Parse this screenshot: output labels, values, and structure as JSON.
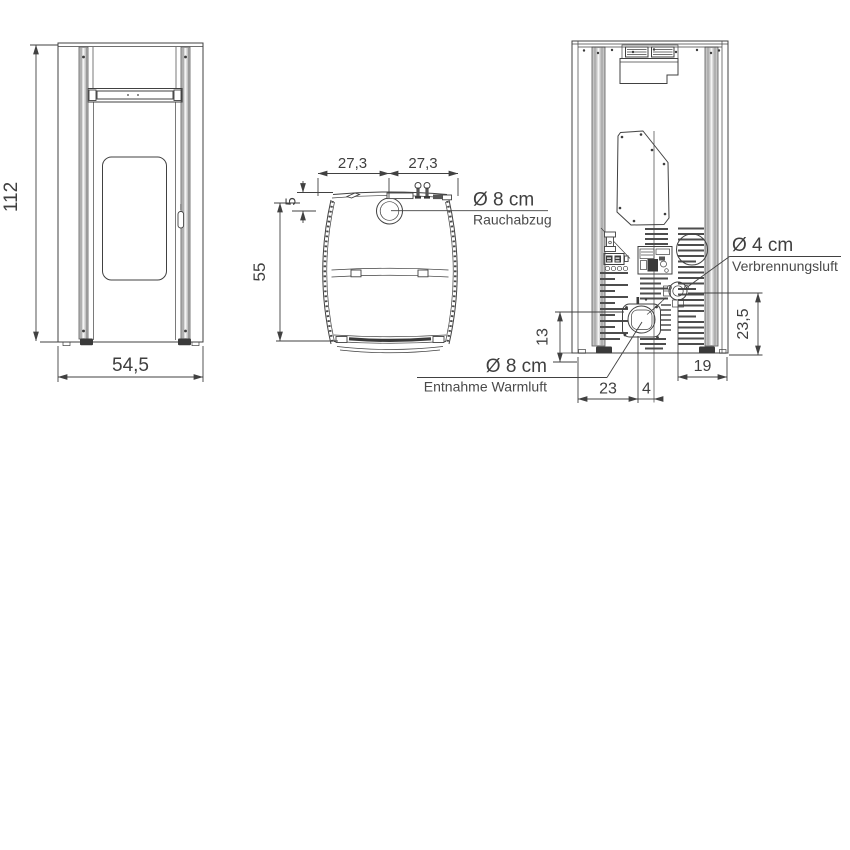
{
  "drawing": {
    "front_view": {
      "height_dim": "112",
      "width_dim": "54,5"
    },
    "top_view": {
      "offset_left_dim": "27,3",
      "offset_right_dim": "27,3",
      "flue_inset_dim": "5",
      "depth_dim": "55",
      "flue": {
        "diameter": "Ø 8 cm",
        "label": "Rauchabzug"
      }
    },
    "rear_view": {
      "combustion_air": {
        "diameter": "Ø 4 cm",
        "label": "Verbrennungsluft"
      },
      "warm_air": {
        "diameter": "Ø 8 cm",
        "label": "Entnahme Warmluft"
      },
      "combustion_height_dim": "23,5",
      "combustion_offset_dim": "19",
      "warm_air_height_dim": "13",
      "warm_air_offset_left_dim": "23",
      "warm_air_offset_center_dim": "4"
    },
    "colors": {
      "line": "#414141",
      "panel_gray": "#c5c5c5",
      "dark": "#3a3a3a",
      "text": "#3f3f3f",
      "background": "#ffffff"
    }
  }
}
